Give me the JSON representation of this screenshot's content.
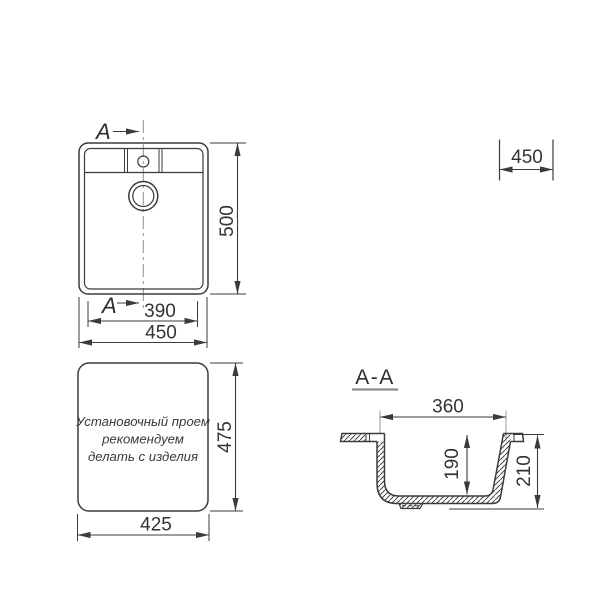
{
  "drawing": {
    "type": "sink-installation-dimension-drawing",
    "colors": {
      "line": "#3b3b3b",
      "extension": "#9a9a9a",
      "centerline": "#8f8f8f",
      "background": "#ffffff"
    },
    "top_view": {
      "section_marker_top": "A",
      "section_marker_bottom": "A",
      "dim_inner_width": "390",
      "dim_outer_width": "450",
      "dim_depth": "500"
    },
    "cabinet_dim": {
      "value": "450"
    },
    "cutout_view": {
      "note_line1": "Установочный проем",
      "note_line2": "рекомендуем",
      "note_line3": "делать с изделия",
      "dim_width": "425",
      "dim_height": "475"
    },
    "section_view": {
      "title": "A-A",
      "dim_opening_width": "360",
      "dim_bowl_depth": "190",
      "dim_total_height": "210"
    }
  }
}
